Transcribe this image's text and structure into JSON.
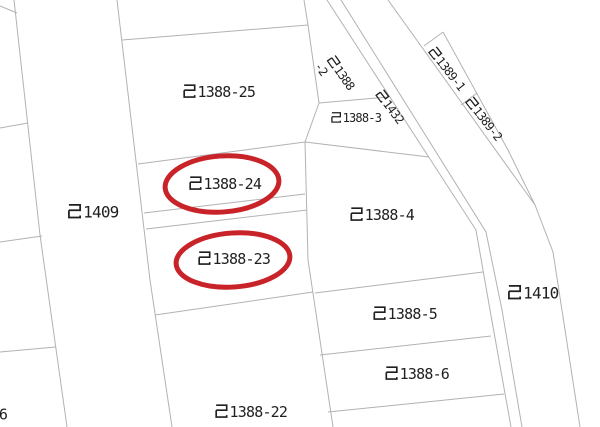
{
  "map": {
    "description_labels_visible": true,
    "colors": {
      "background": "#ffffff",
      "boundary_line": "#b2b2b2",
      "label_text": "#1f1f1f",
      "highlight_red": "#c9232a"
    },
    "labels": [
      {
        "parcel": "1388-25",
        "prefix": "己",
        "text": "1388-25",
        "x": 219,
        "y": 92,
        "rotation": 0,
        "size": 15
      },
      {
        "parcel": "1388-24",
        "prefix": "己",
        "text": "1388-24",
        "x": 225,
        "y": 184,
        "rotation": 0,
        "size": 15
      },
      {
        "parcel": "1388-23",
        "prefix": "己",
        "text": "1388-23",
        "x": 234,
        "y": 259,
        "rotation": 0,
        "size": 15
      },
      {
        "parcel": "1409",
        "prefix": "己",
        "text": "1409",
        "x": 93,
        "y": 212,
        "rotation": 0,
        "size": 16
      },
      {
        "parcel": "1388-2",
        "prefix": "己",
        "text": "1388",
        "x": 341,
        "y": 73,
        "rotation": 55,
        "size": 12
      },
      {
        "parcel": "1388-2",
        "prefix": "",
        "text": "-2",
        "x": 321,
        "y": 69,
        "rotation": 55,
        "size": 12
      },
      {
        "parcel": "1432",
        "prefix": "己",
        "text": "1432",
        "x": 390,
        "y": 107,
        "rotation": 53,
        "size": 12
      },
      {
        "parcel": "1388-3",
        "prefix": "己",
        "text": "1388-3",
        "x": 356,
        "y": 118,
        "rotation": 0,
        "size": 12
      },
      {
        "parcel": "1389-1",
        "prefix": "己",
        "text": "1389-1",
        "x": 447,
        "y": 69,
        "rotation": 52,
        "size": 12
      },
      {
        "parcel": "1389-2",
        "prefix": "己",
        "text": "1389-2",
        "x": 484,
        "y": 119,
        "rotation": 52,
        "size": 12
      },
      {
        "parcel": "1388-4",
        "prefix": "己",
        "text": "1388-4",
        "x": 382,
        "y": 215,
        "rotation": 0,
        "size": 15
      },
      {
        "parcel": "1410",
        "prefix": "己",
        "text": "1410",
        "x": 533,
        "y": 293,
        "rotation": 0,
        "size": 16
      },
      {
        "parcel": "1388-5",
        "prefix": "己",
        "text": "1388-5",
        "x": 405,
        "y": 314,
        "rotation": 0,
        "size": 15
      },
      {
        "parcel": "1388-6",
        "prefix": "己",
        "text": "1388-6",
        "x": 417,
        "y": 374,
        "rotation": 0,
        "size": 15
      },
      {
        "parcel": "1388-22",
        "prefix": "己",
        "text": "1388-22",
        "x": 251,
        "y": 412,
        "rotation": 0,
        "size": 15
      },
      {
        "parcel": "edge-fragment",
        "prefix": "",
        "text": "6",
        "x": 3,
        "y": 415,
        "rotation": 0,
        "size": 15
      }
    ],
    "highlights": [
      {
        "parcel": "1388-24",
        "cx": 222,
        "cy": 184,
        "rx": 57,
        "ry": 28,
        "tilt": -4
      },
      {
        "parcel": "1388-23",
        "cx": 233,
        "cy": 260,
        "rx": 57,
        "ry": 27,
        "tilt": -4
      }
    ]
  }
}
